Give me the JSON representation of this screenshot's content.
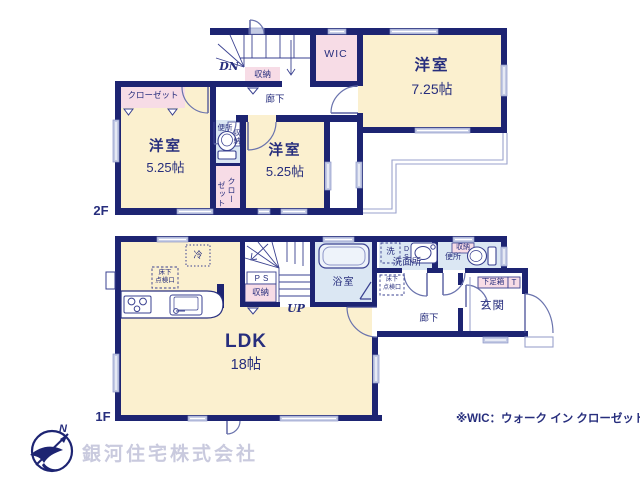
{
  "colors": {
    "wall": "#1d2472",
    "room_fill": "#fbf0cf",
    "closet_fill": "#f7dce6",
    "wet_area_fill": "#dbe7f3",
    "thin_line": "#8d96c8",
    "text": "#272e7d",
    "watermark": "#c9cade"
  },
  "f2": {
    "floor": "2F",
    "west": {
      "name": "洋室",
      "size": "5.25帖"
    },
    "center": {
      "name": "洋室",
      "size": "5.25帖"
    },
    "east": {
      "name": "洋室",
      "size": "7.25帖"
    },
    "wic": "WIC",
    "closet_west": "クローゼット",
    "closet_center_a": "クロー",
    "closet_center_b": "ゼット",
    "toilet": "便所",
    "toilet_storage": "収納",
    "stair_storage": "収納",
    "hallway": "廊下",
    "down": "DN"
  },
  "f1": {
    "floor": "1F",
    "ldk": {
      "name": "LDK",
      "size": "18帖"
    },
    "bath": "浴室",
    "washroom": "洗面所",
    "washer": "洗",
    "duct": "DS",
    "hatch_kitchen": {
      "l1": "床下",
      "l2": "点検口"
    },
    "hatch_hall": {
      "l1": "床下",
      "l2": "点検口"
    },
    "fridge": "冷",
    "ps": "PS",
    "stair_storage": "収納",
    "up": "UP",
    "toilet": "便所",
    "toilet_storage": "収納",
    "hallway": "廊下",
    "genkan": "玄関",
    "shoebox": "下足箱",
    "shoebox_t": "T",
    "kitchen": ""
  },
  "footer": {
    "note": "※WIC：ウォーク イン クローゼット",
    "company": "銀河住宅株式会社",
    "north": "N"
  }
}
